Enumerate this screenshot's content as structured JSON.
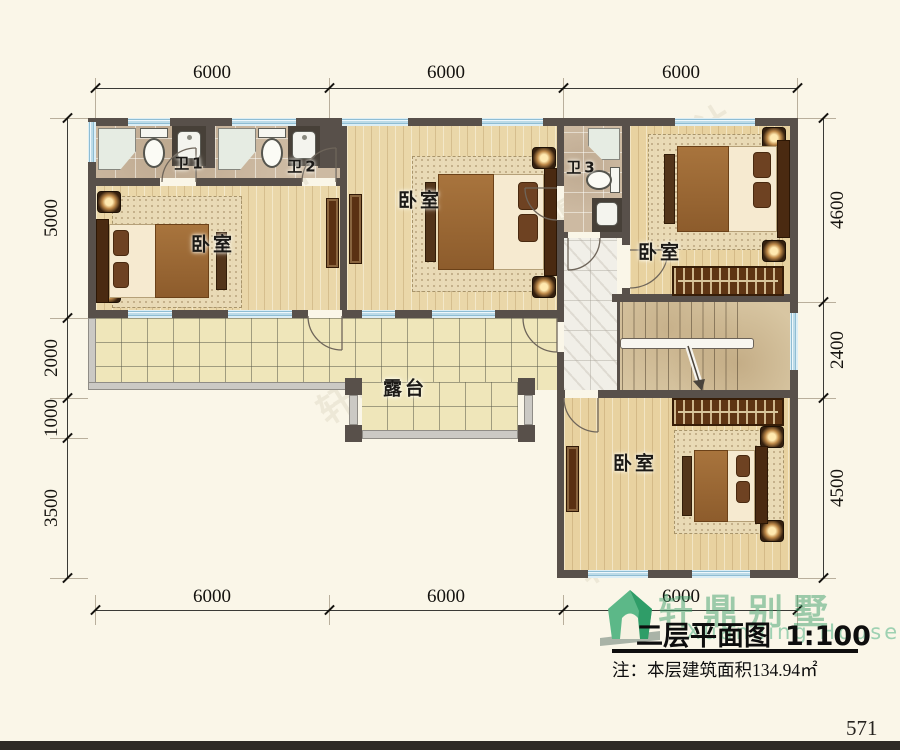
{
  "dims": {
    "top": [
      "6000",
      "6000",
      "6000"
    ],
    "bottom": [
      "6000",
      "6000",
      "6000"
    ],
    "left": [
      "5000",
      "2000",
      "1000",
      "3500"
    ],
    "right": [
      "4600",
      "2400",
      "4500"
    ]
  },
  "rooms": {
    "bedroom_left": "卧室",
    "bedroom_middle": "卧室",
    "bedroom_top_right": "卧室",
    "bedroom_bottom": "卧室",
    "bath1": "卫1",
    "bath2": "卫2",
    "bath3": "卫3",
    "terrace": "露台"
  },
  "title_block": {
    "brand": "轩鼎别墅",
    "brand_en": "Xuanding House",
    "title": "二层平面图",
    "scale": "1:100",
    "note": "注：本层建筑面积134.94㎡"
  },
  "watermark": "轩鼎建筑设计",
  "page_number": "571",
  "colors": {
    "wall": "#58504a",
    "window_blue": "#bcdbe8",
    "brand_green": "#3e9e6a",
    "terrace_tile": "#efe6ba",
    "wood_floor": "#ead7a9"
  }
}
